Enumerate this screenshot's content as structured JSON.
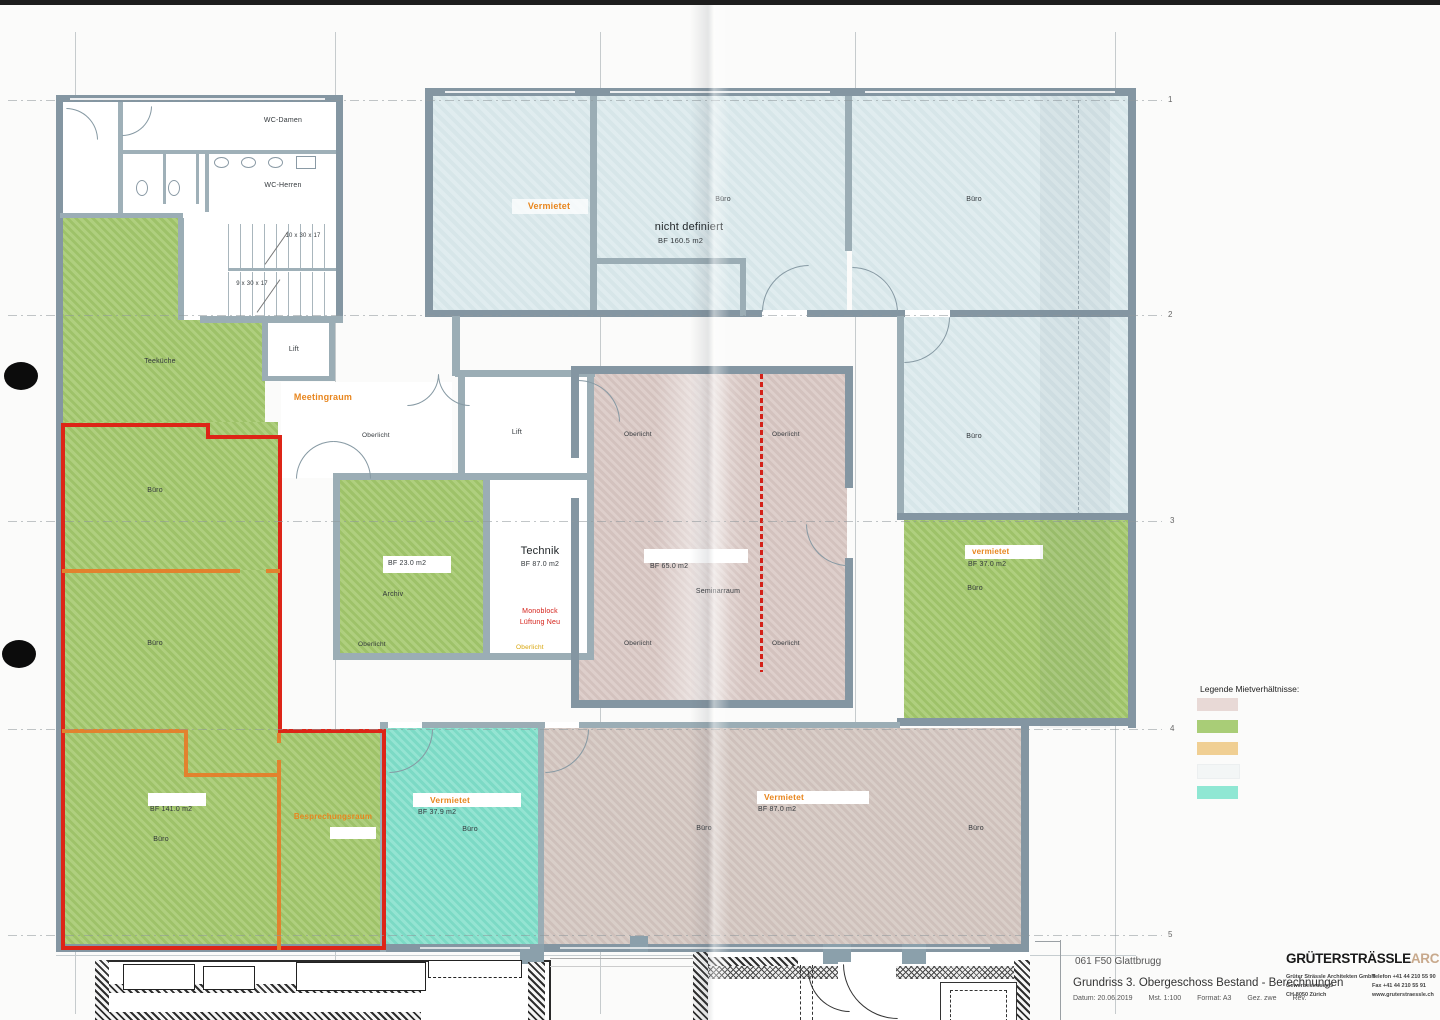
{
  "plan": {
    "wc_damen": "WC-Damen",
    "wc_herren": "WC-Herren",
    "stairs": {
      "upper": "10 x 30 x 17",
      "lower": "9 x 30 x 17"
    },
    "teekueche": "Teeküche",
    "lift": "Lift",
    "meetingraum": "Meetingraum",
    "buero": "Büro",
    "oberlicht": "Oberlicht",
    "archiv": {
      "name": "Archiv",
      "bf": "BF  23.0 m2"
    },
    "technik": {
      "name": "Technik",
      "bf": "BF   87.0 m2"
    },
    "monoblock": {
      "l1": "Monoblock",
      "l2": "Lüftung Neu"
    },
    "seminar": {
      "name": "Seminarraum",
      "bf": "BF   65.0 m2"
    },
    "top": {
      "vermietet": "Vermietet",
      "nicht_definiert": "nicht definiert",
      "nd_bf": "BF  160.5 m2"
    },
    "vermietet": "Vermietet",
    "vermietet_lc": "vermietet",
    "right_green_bf": "BF   37.0 m2",
    "bl_bf": "BF  141.0 m2",
    "besprechungsraum": "Besprechungsraum",
    "cyan_bf": "BF   37.9 m2",
    "bottom_bf": "BF   87.0 m2"
  },
  "grid": {
    "rows": [
      "1",
      "2",
      "3",
      "4",
      "5"
    ]
  },
  "legend": {
    "title": "Legende Mietverhältnisse:",
    "swatches": [
      {
        "name": "mietverhaeltnis-rosa",
        "color": "#e8d9d6"
      },
      {
        "name": "mietverhaeltnis-gruen",
        "color": "#a9cd77"
      },
      {
        "name": "mietverhaeltnis-orange",
        "color": "#f0cf93"
      },
      {
        "name": "mietverhaeltnis-weiss",
        "color": "#f3f6f6"
      },
      {
        "name": "mietverhaeltnis-cyan",
        "color": "#8fe7d3"
      }
    ]
  },
  "title_block": {
    "project": "061 F50 Glattbrugg",
    "title": "Grundriss 3. Obergeschoss Bestand - Berechnungen",
    "meta": {
      "date": "Datum: 20.06.2019",
      "scale": "Mst. 1:100",
      "format": "Format: A3",
      "drawn": "Gez. zwe",
      "rev": "Rev."
    }
  },
  "architect": {
    "name": "GRÜTERSTRÄSSLE",
    "suffix": "ARCHITEKTEN",
    "firm": "Grüter Strässle Architekten GmbH",
    "street": "Gewerbestrasse 9",
    "city": "CH-8050 Zürich",
    "phone": "Telefon   +41 44 210 55 90",
    "fax": "Fax        +41 44 210 55 91",
    "web": "www.gruterstraessle.ch"
  },
  "colors": {
    "green": "#a6ca70",
    "blue": "#dceaed",
    "mauve": "#d9c8c4",
    "cyan": "#83e0cb",
    "accent_orange": "#e8861e",
    "line_red": "#dd2517",
    "line_orange": "#e2822e",
    "wall_gray": "#8496a2",
    "logo_tan": "#c8a98c"
  }
}
